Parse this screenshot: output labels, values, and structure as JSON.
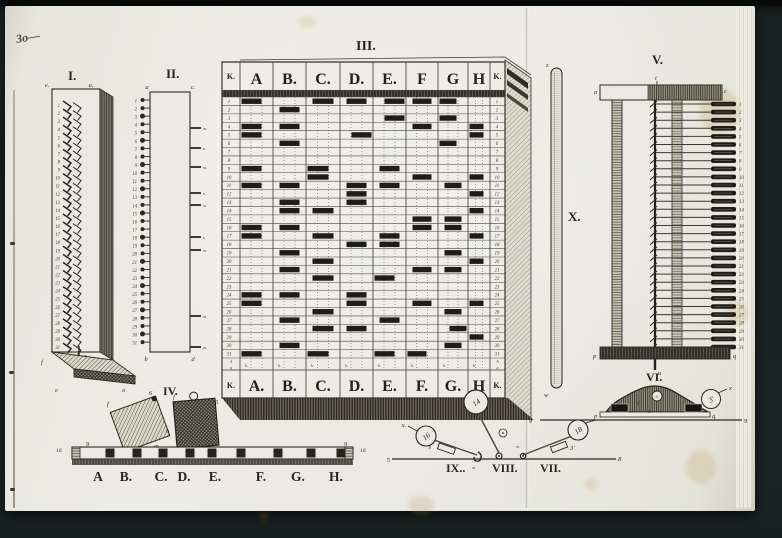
{
  "note_handwritten": "3o—",
  "figI": {
    "label": "I.",
    "top_left": "e.",
    "top_right": "a.",
    "right": "c.",
    "bottom_left": "f",
    "pin": "z",
    "base_left": "e",
    "base_right": "o",
    "count": 31
  },
  "figII": {
    "label": "II.",
    "top_left": "a",
    "top_right": "c.",
    "bottom_left": "b",
    "bottom_right": "d",
    "count": 31,
    "ticks": [
      {
        "y": 128,
        "t": "m."
      },
      {
        "y": 148,
        "t": "n."
      },
      {
        "y": 167,
        "t": "m."
      },
      {
        "y": 193,
        "t": "n."
      },
      {
        "y": 205,
        "t": "m."
      },
      {
        "y": 237,
        "t": "n."
      },
      {
        "y": 250,
        "t": "m."
      },
      {
        "y": 316,
        "t": "m."
      },
      {
        "y": 347,
        "t": "m."
      }
    ]
  },
  "figIII": {
    "label": "III.",
    "headers_top": [
      "K.",
      "A",
      "B.",
      "C.",
      "D.",
      "E.",
      "F",
      "G",
      "H",
      "K."
    ],
    "headers_bottom": [
      "K.",
      "A.",
      "B.",
      "C.",
      "D.",
      "E.",
      "F.",
      "G.",
      "H",
      "K."
    ],
    "cols": [
      [
        222,
        240
      ],
      [
        240,
        273
      ],
      [
        273,
        306
      ],
      [
        306,
        340
      ],
      [
        340,
        373
      ],
      [
        373,
        406
      ],
      [
        406,
        438
      ],
      [
        438,
        468
      ],
      [
        468,
        490
      ],
      [
        490,
        505
      ]
    ],
    "rows": 31,
    "sub_mark": "h.",
    "sub_k_top": "A",
    "sub_k_bottom": "g",
    "bars": {
      "A": [
        [
          1,
          0
        ],
        [
          4,
          0
        ],
        [
          5,
          0
        ],
        [
          9,
          0
        ],
        [
          11,
          0
        ],
        [
          16,
          0
        ],
        [
          17,
          0
        ],
        [
          24,
          0
        ],
        [
          25,
          0
        ],
        [
          31,
          0
        ]
      ],
      "B": [
        [
          2,
          1
        ],
        [
          4,
          1
        ],
        [
          6,
          1
        ],
        [
          11,
          1
        ],
        [
          13,
          1
        ],
        [
          14,
          1
        ],
        [
          16,
          1
        ],
        [
          19,
          1
        ],
        [
          21,
          1
        ],
        [
          24,
          1
        ],
        [
          27,
          1
        ],
        [
          30,
          1
        ]
      ],
      "C": [
        [
          1,
          1
        ],
        [
          9,
          0
        ],
        [
          10,
          0
        ],
        [
          14,
          1
        ],
        [
          17,
          1
        ],
        [
          20,
          1
        ],
        [
          22,
          1
        ],
        [
          26,
          1
        ],
        [
          28,
          1
        ],
        [
          31,
          0
        ]
      ],
      "D": [
        [
          1,
          1
        ],
        [
          5,
          2
        ],
        [
          11,
          1
        ],
        [
          12,
          1
        ],
        [
          13,
          1
        ],
        [
          18,
          1
        ],
        [
          24,
          1
        ],
        [
          25,
          1
        ],
        [
          28,
          1
        ]
      ],
      "E": [
        [
          1,
          2
        ],
        [
          3,
          2
        ],
        [
          9,
          1
        ],
        [
          11,
          1
        ],
        [
          17,
          1
        ],
        [
          18,
          1
        ],
        [
          22,
          0
        ],
        [
          27,
          1
        ],
        [
          31,
          0
        ]
      ],
      "F": [
        [
          1,
          1
        ],
        [
          4,
          1
        ],
        [
          10,
          1
        ],
        [
          15,
          1
        ],
        [
          16,
          1
        ],
        [
          21,
          1
        ],
        [
          25,
          1
        ],
        [
          31,
          0
        ]
      ],
      "G": [
        [
          1,
          0
        ],
        [
          3,
          0
        ],
        [
          6,
          0
        ],
        [
          11,
          1
        ],
        [
          15,
          1
        ],
        [
          16,
          1
        ],
        [
          19,
          1
        ],
        [
          21,
          1
        ],
        [
          26,
          1
        ],
        [
          28,
          2
        ],
        [
          30,
          1
        ]
      ],
      "H": [
        [
          4,
          0
        ],
        [
          5,
          0
        ],
        [
          10,
          0
        ],
        [
          12,
          0
        ],
        [
          14,
          0
        ],
        [
          17,
          0
        ],
        [
          20,
          0
        ],
        [
          25,
          0
        ],
        [
          29,
          0
        ]
      ]
    }
  },
  "figIV": {
    "label": "IV.",
    "letters": [
      [
        "A",
        98
      ],
      [
        "B.",
        126
      ],
      [
        "C.",
        161
      ],
      [
        "D.",
        184
      ],
      [
        "E.",
        215
      ],
      [
        "F.",
        261
      ],
      [
        "G.",
        298
      ],
      [
        "H.",
        336
      ]
    ],
    "blocks": [
      110,
      137,
      163,
      190,
      212,
      241,
      278,
      311,
      341
    ],
    "left_end": "18.",
    "left_nine": "9",
    "right_nine": "9",
    "right_end": "18.",
    "sq1_top": "6",
    "sq1_tl": "f",
    "sq1_bl": "e",
    "sq1_br": "m",
    "sq1_r": "b",
    "sq2_tl": "f",
    "sq2_tr": "6"
  },
  "figV": {
    "label": "V.",
    "top_left": "a",
    "top_mid": "t",
    "top_right": "c",
    "base_left": "p",
    "base_right": "q",
    "stem": "u",
    "count": 31
  },
  "figVI": {
    "label": "VI.",
    "bar_left": "p",
    "bar_right": "q.",
    "line_left": "9",
    "line_right": "9",
    "top_circle": "G",
    "inner": "8",
    "inner2": "L",
    "circle": "3′",
    "x": "x"
  },
  "figVII": {
    "label": "VII.",
    "circle": "18",
    "rect_label": "3′",
    "pivot": "m.",
    "end": "8"
  },
  "figVIII": {
    "label": "VIII.",
    "circle": "14"
  },
  "figIX": {
    "label": "IX..",
    "circle": "16",
    "rect_label": "s",
    "x": "x.",
    "left_end": "5",
    "pivot": "m."
  },
  "figX": {
    "label": "X.",
    "top": "z",
    "bottom": "w"
  },
  "colors": {
    "paper": "#ebeae2",
    "ink": "#2b2820",
    "bar": "#1f1d17",
    "band": "#34312a"
  }
}
